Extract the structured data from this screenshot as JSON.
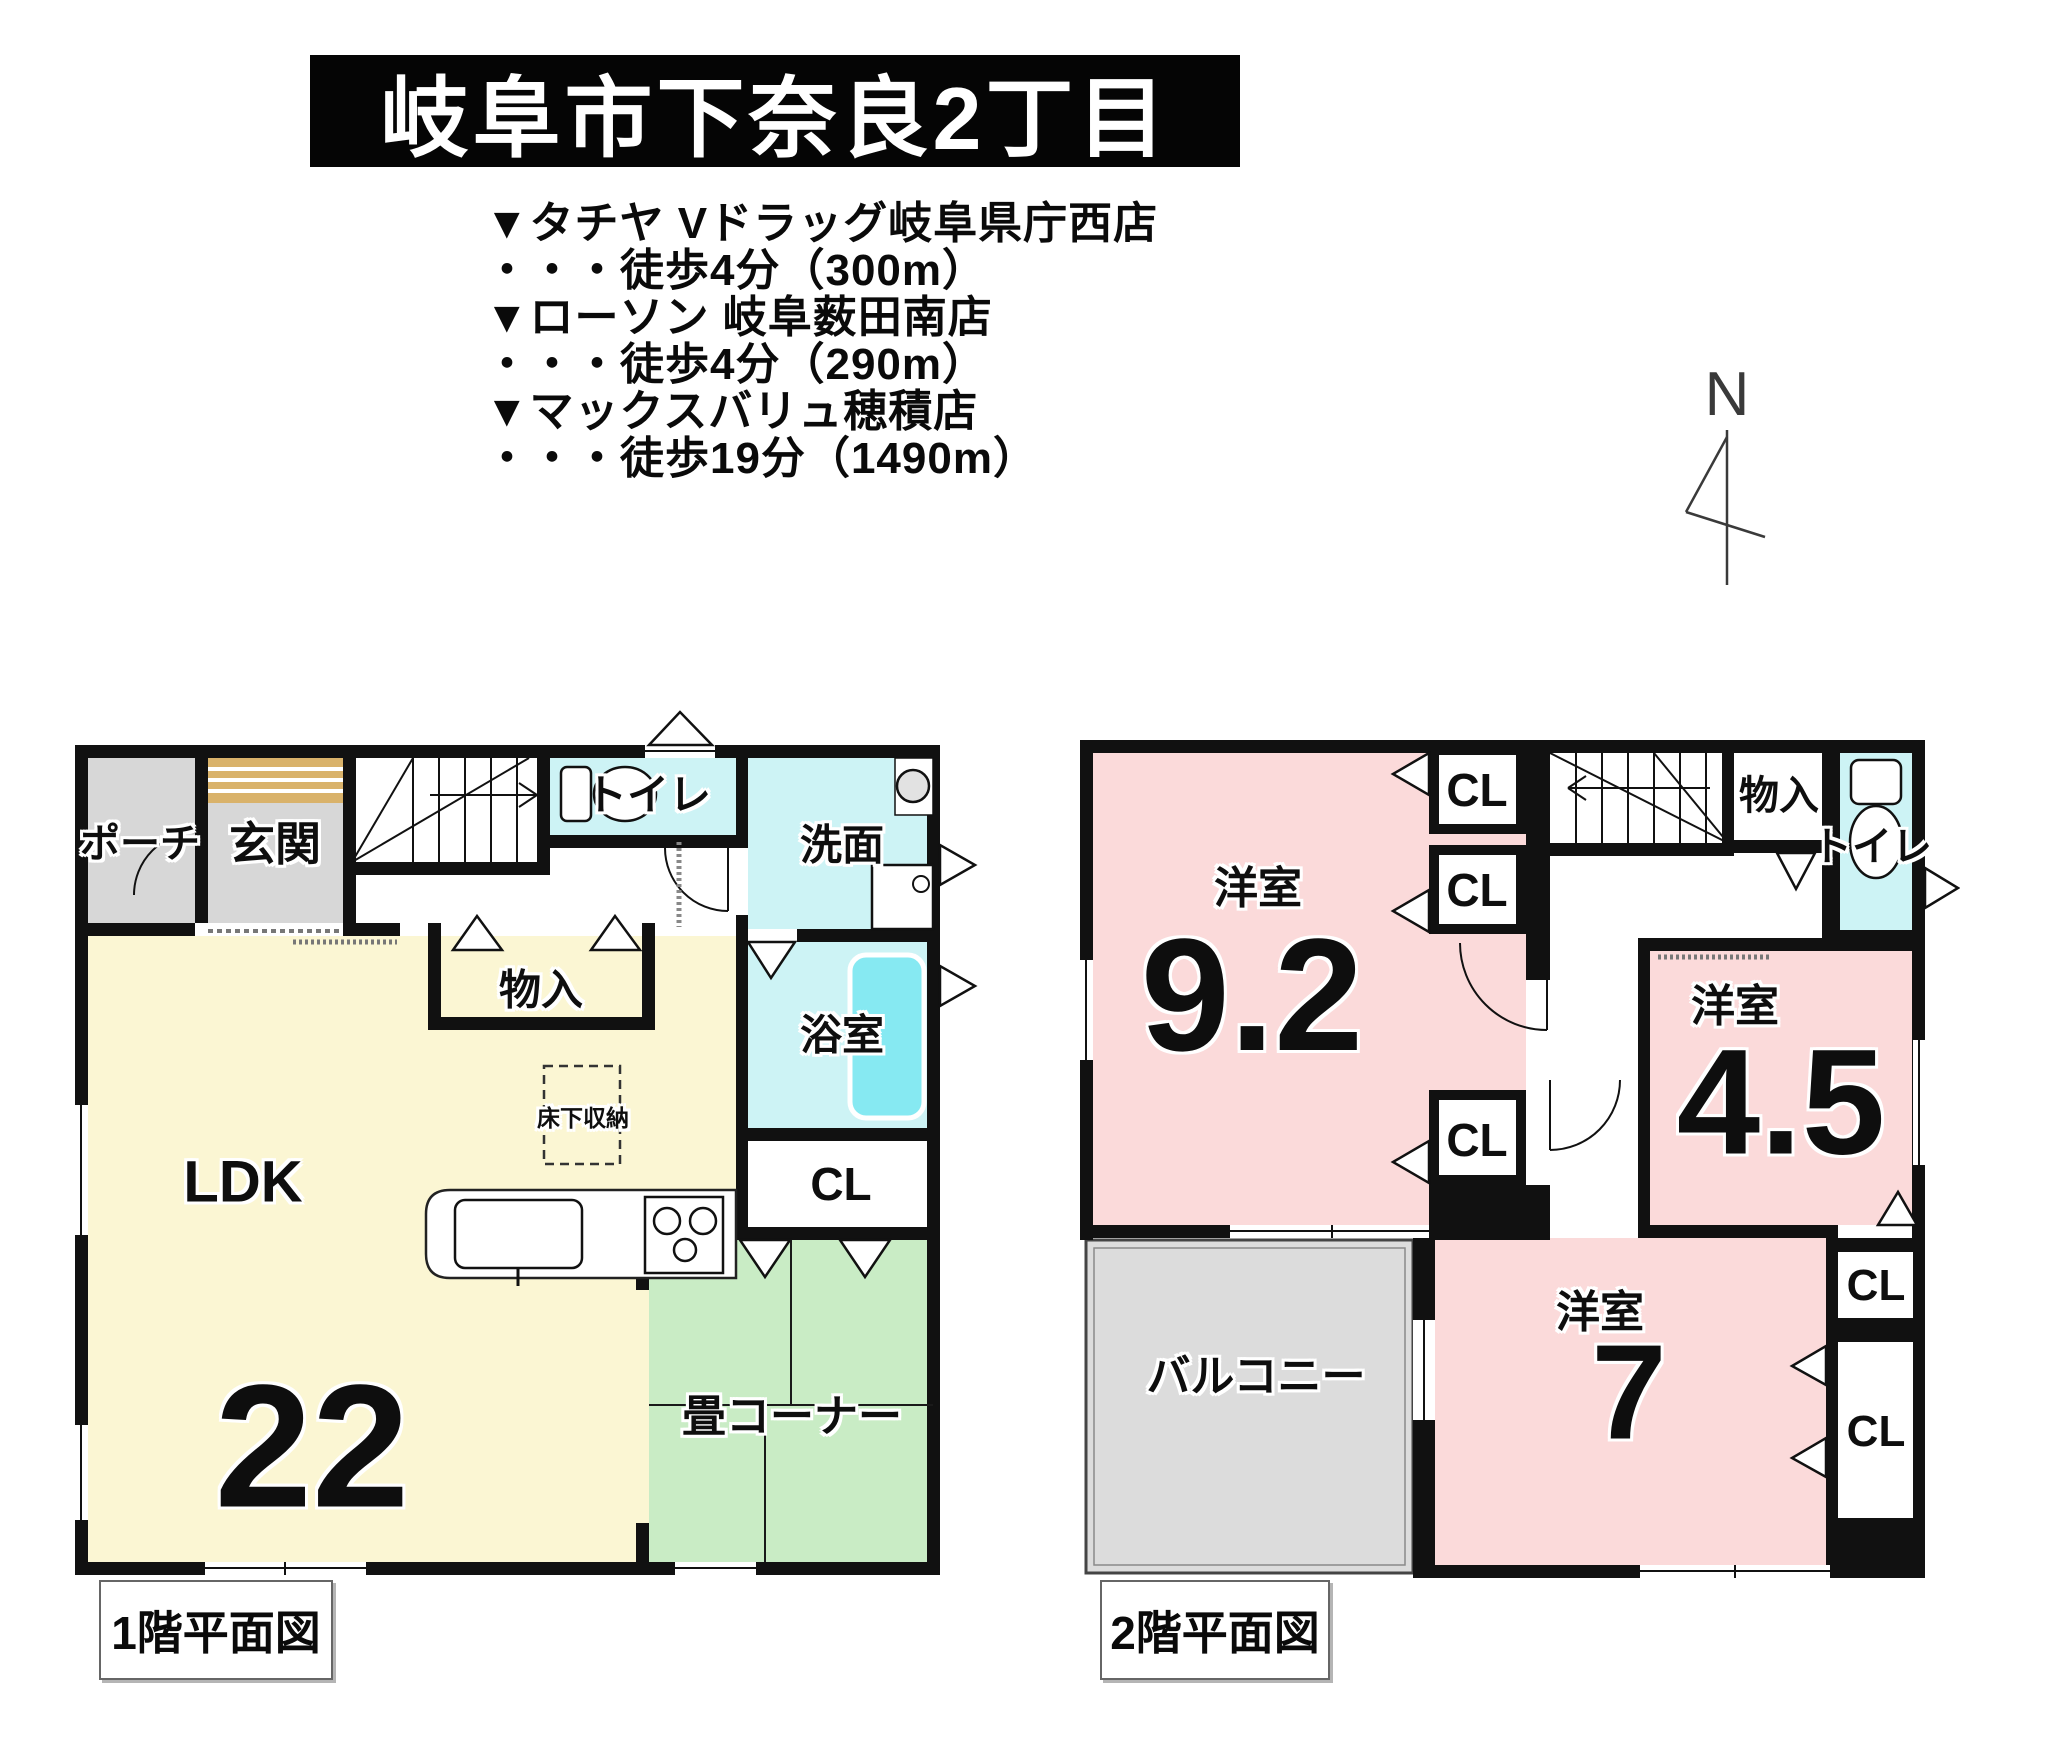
{
  "title": "岐阜市下奈良2丁目",
  "nearby": {
    "lines": [
      "▼タチヤ Vドラッグ岐阜県庁西店",
      "・・・徒歩4分（300m）",
      "▼ローソン 岐阜薮田南店",
      "・・・徒歩4分（290m）",
      "▼マックスバリュ穂積店",
      "・・・徒歩19分（1490m）"
    ]
  },
  "compass": {
    "label": "N"
  },
  "floor1": {
    "caption": "1階平面図",
    "rooms": {
      "porch": "ポーチ",
      "entrance": "玄関",
      "toilet": "トイレ",
      "washroom": "洗面",
      "storage": "物入",
      "bathroom": "浴室",
      "closet": "CL",
      "ldk": "LDK",
      "ldk_size": "22",
      "underfloor_storage": "床下収納",
      "tatami_corner": "畳コーナー"
    }
  },
  "floor2": {
    "caption": "2階平面図",
    "rooms": {
      "west_room_large": "洋室",
      "west_room_large_size": "9.2",
      "west_room_mid": "洋室",
      "west_room_mid_size": "4.5",
      "west_room_small": "洋室",
      "west_room_small_size": "7",
      "closet": "CL",
      "storage": "物入",
      "toilet": "トイレ",
      "balcony": "バルコニー"
    }
  },
  "colors": {
    "wall": "#111111",
    "ldk": "#fbf6d3",
    "tatami": "#c9ecc5",
    "western_room": "#fbdada",
    "wet_area": "#cdf3f5",
    "bathtub": "#86e9f2",
    "porch_gray": "#d7d7d7",
    "balcony_gray": "#dcdcdc",
    "entrance_step": "#d9b26a",
    "banner_bg": "#050505",
    "banner_text": "#ffffff"
  }
}
